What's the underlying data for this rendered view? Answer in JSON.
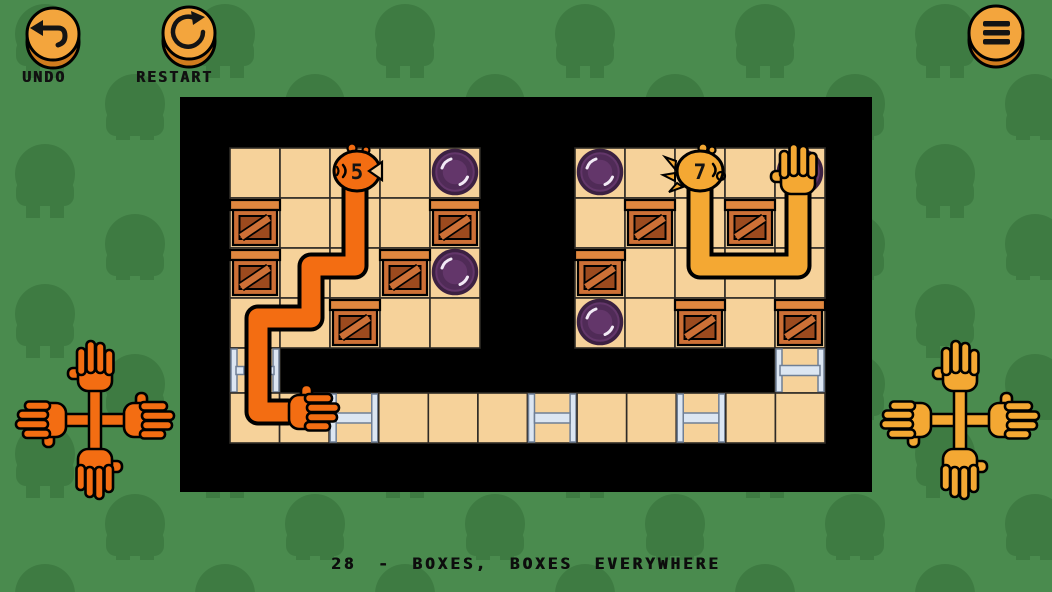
{
  "hud": {
    "undo": {
      "label": "UNDO",
      "icon": "undo-arrow-icon"
    },
    "restart": {
      "label": "RESTART",
      "icon": "restart-circular-arrow-icon"
    },
    "menu": {
      "icon": "hamburger-menu-icon"
    }
  },
  "caption": "28 - BOXES, BOXES EVERYWHERE",
  "level_number": "28",
  "level_title": "BOXES, BOXES EVERYWHERE",
  "colors": {
    "bg_green": "#4a8b4e",
    "bg_tree": "#3e7b42",
    "board_bg": "#000000",
    "floor": "#f6d29a",
    "grid_line": "#2e2a26",
    "rail_fill": "#dce6f2",
    "rail_edge": "#6f7f95",
    "crate_light": "#cd7036",
    "crate_dark": "#9c4a1e",
    "crate_lid": "#e0873f",
    "button_face": "#63366a",
    "button_edge": "#3c2142",
    "button_ring": "#502b57",
    "button_shine": "#f2eaf6",
    "arm_orange": "#f36d12",
    "arm_yellow": "#f4a833",
    "hud_button_face": "#f3a53d",
    "hud_button_rim": "#d07c1e",
    "text": "#111111"
  },
  "board": {
    "x": 180,
    "y": 97,
    "w": 692,
    "h": 395,
    "cell": 50,
    "rooms": [
      {
        "name": "left-room",
        "x": 230,
        "y": 148,
        "cols": 5,
        "rows": 4
      },
      {
        "name": "right-room",
        "x": 575,
        "y": 148,
        "cols": 5,
        "rows": 4
      }
    ],
    "corridor": {
      "x": 230,
      "y": 393,
      "cells": 12,
      "cellW": 49.583,
      "h": 50,
      "ladder_cells": [
        2,
        6,
        9
      ]
    },
    "shafts": [
      {
        "x": 230,
        "y": 348,
        "w": 50,
        "h": 45,
        "rung": "stubs"
      },
      {
        "x": 775,
        "y": 348,
        "w": 50,
        "h": 45,
        "rung": "full"
      }
    ],
    "crates": [
      {
        "x": 255,
        "y": 222
      },
      {
        "x": 255,
        "y": 272
      },
      {
        "x": 405,
        "y": 272
      },
      {
        "x": 355,
        "y": 322
      },
      {
        "x": 455,
        "y": 222
      },
      {
        "x": 650,
        "y": 222
      },
      {
        "x": 750,
        "y": 222
      },
      {
        "x": 600,
        "y": 272
      },
      {
        "x": 700,
        "y": 322
      },
      {
        "x": 800,
        "y": 322
      }
    ],
    "buttons": [
      {
        "x": 455,
        "y": 172
      },
      {
        "x": 455,
        "y": 272
      },
      {
        "x": 600,
        "y": 172
      },
      {
        "x": 600,
        "y": 322
      },
      {
        "x": 800,
        "y": 172
      }
    ],
    "arms": [
      {
        "name": "orange-arm",
        "color_key": "arm_orange",
        "number": "5",
        "head": {
          "x": 357,
          "y": 171,
          "facing": "left"
        },
        "path": [
          [
            355,
            178
          ],
          [
            355,
            266
          ],
          [
            311,
            266
          ],
          [
            311,
            318
          ],
          [
            258,
            318
          ],
          [
            258,
            412
          ],
          [
            288,
            412
          ]
        ],
        "hand": {
          "x": 293,
          "y": 412,
          "dir": "right"
        }
      },
      {
        "name": "yellow-arm",
        "color_key": "arm_yellow",
        "number": "7",
        "head": {
          "x": 700,
          "y": 171,
          "facing": "right"
        },
        "path": [
          [
            700,
            178
          ],
          [
            700,
            266
          ],
          [
            798,
            266
          ],
          [
            798,
            186
          ]
        ],
        "hand": {
          "x": 798,
          "y": 190,
          "dir": "up"
        }
      }
    ]
  },
  "decorations": {
    "crosses": [
      {
        "name": "left-hand-cross",
        "cx": 95,
        "cy": 420,
        "color_key": "arm_orange"
      },
      {
        "name": "right-hand-cross",
        "cx": 960,
        "cy": 420,
        "color_key": "arm_yellow"
      }
    ]
  }
}
